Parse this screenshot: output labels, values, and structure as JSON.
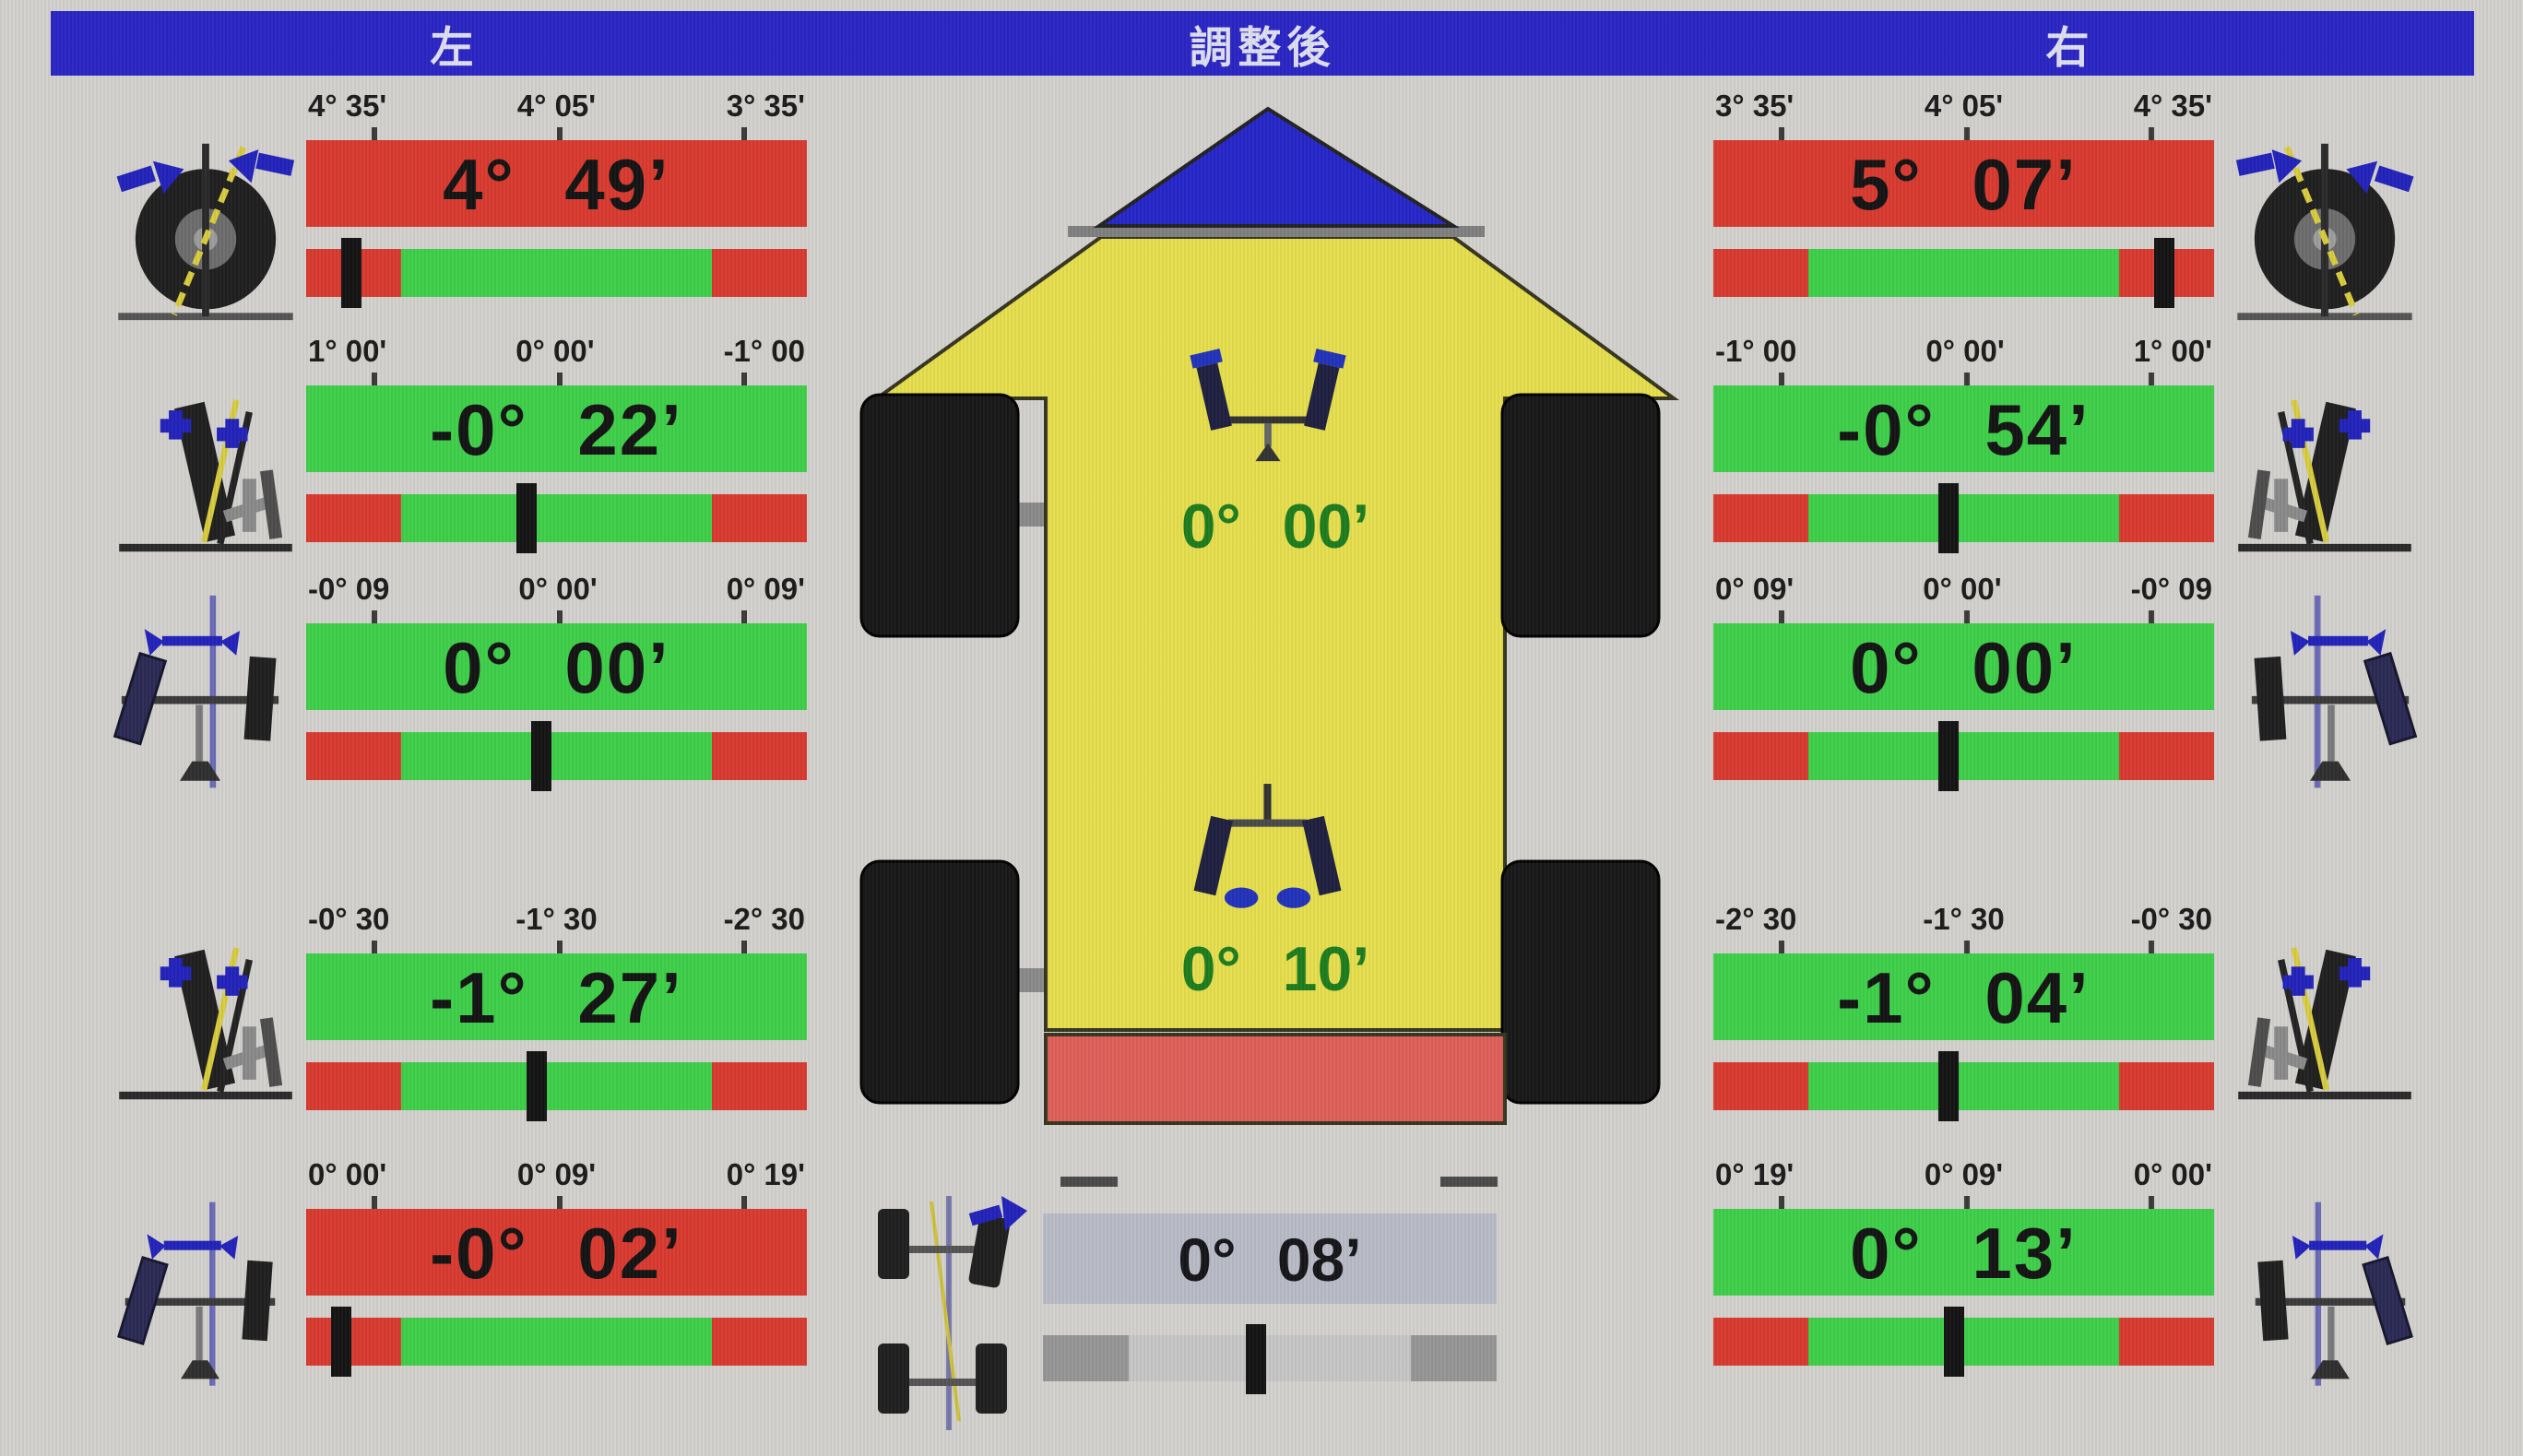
{
  "header": {
    "left": "左",
    "center": "調整後",
    "right": "右"
  },
  "colors": {
    "header_bg": "#2b25c5",
    "ok_green": "#3fd04a",
    "ng_red": "#d93a30",
    "car_yellow": "#e6df4e",
    "roof_blue": "#2626c9",
    "bumper_red": "#e05f5a",
    "thrust_bar_bg": "#b9bcc6",
    "center_text_green": "#1e7d1e"
  },
  "icons": {
    "left_column": [
      "caster-icon",
      "camber-icon",
      "toe-icon",
      "camber-icon",
      "toe-icon"
    ],
    "right_column": [
      "caster-icon",
      "camber-icon",
      "toe-icon",
      "camber-icon",
      "toe-icon"
    ],
    "center": [
      "front-toe-icon",
      "rear-toe-icon",
      "thrust-angle-icon",
      "car-top-view"
    ]
  },
  "left": {
    "rows": [
      {
        "labels": [
          "4° 35'",
          "4° 05'",
          "3° 35'"
        ],
        "value": "4° 49’",
        "value_bg": "#d93a30",
        "indicator": "9%"
      },
      {
        "labels": [
          "1° 00'",
          "0° 00'",
          "-1° 00"
        ],
        "value": "-0° 22’",
        "value_bg": "#3fd04a",
        "indicator": "44%"
      },
      {
        "labels": [
          "-0° 09",
          "0° 00'",
          "0° 09'"
        ],
        "value": "0° 00’",
        "value_bg": "#3fd04a",
        "indicator": "47%"
      },
      {
        "labels": [
          "-0° 30",
          "-1° 30",
          "-2° 30"
        ],
        "value": "-1° 27’",
        "value_bg": "#3fd04a",
        "indicator": "46%"
      },
      {
        "labels": [
          "0° 00'",
          "0° 09'",
          "0° 19'"
        ],
        "value": "-0° 02’",
        "value_bg": "#d93a30",
        "indicator": "7%"
      }
    ]
  },
  "right": {
    "rows": [
      {
        "labels": [
          "3° 35'",
          "4° 05'",
          "4° 35'"
        ],
        "value": "5° 07’",
        "value_bg": "#d93a30",
        "indicator": "90%"
      },
      {
        "labels": [
          "-1° 00",
          "0° 00'",
          "1° 00'"
        ],
        "value": "-0° 54’",
        "value_bg": "#3fd04a",
        "indicator": "47%"
      },
      {
        "labels": [
          "0° 09'",
          "0° 00'",
          "-0° 09"
        ],
        "value": "0° 00’",
        "value_bg": "#3fd04a",
        "indicator": "47%"
      },
      {
        "labels": [
          "-2° 30",
          "-1° 30",
          "-0° 30"
        ],
        "value": "-1° 04’",
        "value_bg": "#3fd04a",
        "indicator": "47%"
      },
      {
        "labels": [
          "0° 19'",
          "0° 09'",
          "0° 00'"
        ],
        "value": "0° 13’",
        "value_bg": "#3fd04a",
        "indicator": "48%"
      }
    ]
  },
  "center": {
    "front_toe_total": "0° 00’",
    "rear_toe_total": "0° 10’",
    "thrust_angle": "0° 08’",
    "thrust_indicator": "47%"
  }
}
